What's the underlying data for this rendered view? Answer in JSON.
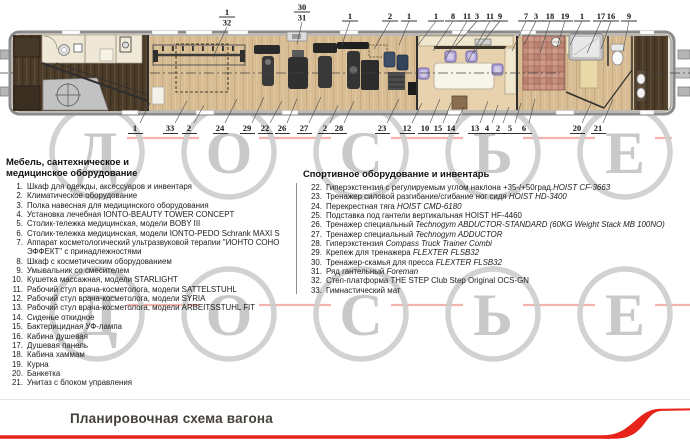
{
  "watermark": {
    "letters": [
      "Д",
      "О",
      "С",
      "Ь",
      "Е"
    ],
    "circle_color": "#cdcdcd",
    "letter_color": "#c7c7c7",
    "line_color": "#f2a6a0"
  },
  "plan": {
    "top_callouts": [
      {
        "t": "1",
        "b": "32",
        "x": 227,
        "yb": 17,
        "dx": -14,
        "dy": 30
      },
      {
        "t": "30",
        "b": "31",
        "x": 302,
        "yb": 12,
        "dx": -5,
        "dy": 22
      },
      {
        "t": "1",
        "x": 350,
        "dx": -8,
        "dy": 24
      },
      {
        "t": "2",
        "x": 390,
        "dx": -16,
        "dy": 28
      },
      {
        "t": "1",
        "x": 409,
        "dx": -10,
        "dy": 24
      },
      {
        "t": "1",
        "x": 436,
        "dx": -18,
        "dy": 24
      },
      {
        "t": "8",
        "x": 453,
        "dx": -20,
        "dy": 30
      },
      {
        "t": "11",
        "x": 467,
        "dx": -22,
        "dy": 38
      },
      {
        "t": "3",
        "x": 477,
        "dx": -24,
        "dy": 28
      },
      {
        "t": "11",
        "x": 490,
        "dx": -22,
        "dy": 40
      },
      {
        "t": "9",
        "x": 500,
        "dx": -26,
        "dy": 32
      },
      {
        "t": "7",
        "x": 526,
        "dx": -14,
        "dy": 30
      },
      {
        "t": "3",
        "x": 536,
        "dx": -12,
        "dy": 24
      },
      {
        "t": "18",
        "x": 550,
        "dx": -10,
        "dy": 32
      },
      {
        "t": "19",
        "x": 565,
        "dx": -8,
        "dy": 26
      },
      {
        "t": "1",
        "x": 582,
        "dx": -12,
        "dy": 24
      },
      {
        "t": "17",
        "x": 601,
        "dx": -14,
        "dy": 32
      },
      {
        "t": "16",
        "x": 611,
        "dx": -10,
        "dy": 28
      },
      {
        "t": "9",
        "x": 629,
        "dx": -6,
        "dy": 30
      }
    ],
    "bottom_callouts": [
      {
        "t": "1",
        "x": 135,
        "dx": 10,
        "dy": 20
      },
      {
        "t": "33",
        "x": 170,
        "dx": 12,
        "dy": 22
      },
      {
        "t": "2",
        "x": 189,
        "dx": 10,
        "dy": 18
      },
      {
        "t": "24",
        "x": 220,
        "dx": 12,
        "dy": 24
      },
      {
        "t": "29",
        "x": 247,
        "dx": 12,
        "dy": 26
      },
      {
        "t": "22",
        "x": 265,
        "dx": 12,
        "dy": 22
      },
      {
        "t": "26",
        "x": 282,
        "dx": 10,
        "dy": 24
      },
      {
        "t": "27",
        "x": 304,
        "dx": 12,
        "dy": 26
      },
      {
        "t": "2",
        "x": 325,
        "dx": 8,
        "dy": 18
      },
      {
        "t": "28",
        "x": 339,
        "dx": 10,
        "dy": 22
      },
      {
        "t": "23",
        "x": 382,
        "dx": 12,
        "dy": 24
      },
      {
        "t": "12",
        "x": 407,
        "dx": 10,
        "dy": 20
      },
      {
        "t": "10",
        "x": 425,
        "dx": 10,
        "dy": 24
      },
      {
        "t": "15",
        "x": 438,
        "dx": 8,
        "dy": 20
      },
      {
        "t": "14",
        "x": 451,
        "dx": 8,
        "dy": 16
      },
      {
        "t": "13",
        "x": 475,
        "dx": 8,
        "dy": 22
      },
      {
        "t": "4",
        "x": 487,
        "dx": 6,
        "dy": 18
      },
      {
        "t": "2",
        "x": 498,
        "dx": 6,
        "dy": 16
      },
      {
        "t": "5",
        "x": 510,
        "dx": 6,
        "dy": 20
      },
      {
        "t": "6",
        "x": 524,
        "dx": 6,
        "dy": 24
      },
      {
        "t": "20",
        "x": 577,
        "dx": 10,
        "dy": 22
      },
      {
        "t": "21",
        "x": 598,
        "dx": 10,
        "dy": 24
      }
    ]
  },
  "left_list": {
    "title": [
      "Мебель, сантехническое и",
      "медицинское оборудование"
    ],
    "items": [
      {
        "num": "1.",
        "text": "Шкаф для одежды, аксессуаров и инвентаря"
      },
      {
        "num": "2.",
        "text": "Климатическое оборудование"
      },
      {
        "num": "3.",
        "text": "Полка навесная для медицинского оборудования"
      },
      {
        "num": "4.",
        "text": "Установка лечебная IONTO-BEAUTY TOWER CONCEPT"
      },
      {
        "num": "5.",
        "text": "Столик-тележка медицинская, модели BOBY III"
      },
      {
        "num": "6.",
        "text": "Столик-тележка медицинская, модели IONTO-PEDO Schrank MAXI S"
      },
      {
        "num": "7.",
        "text": "Аппарат косметологический ультразвуковой терапии \"ИОНТО СОНО ЭФФЕКТ\" с принадлежностями"
      },
      {
        "num": "8.",
        "text": "Шкаф с косметическим оборудованием"
      },
      {
        "num": "9.",
        "text": "Умывальник со смесителем"
      },
      {
        "num": "10.",
        "text": "Кушетка массажная, модели STARLIGHT"
      },
      {
        "num": "11.",
        "text": "Рабочий стул врача-косметолога, модели SATTELSTUHL"
      },
      {
        "num": "12.",
        "text": "Рабочий стул врача-косметолога, модели SYRIA"
      },
      {
        "num": "13.",
        "text": "Рабочий стул врача-косметолога, модели ARBEITSSTUHL FIT"
      },
      {
        "num": "14.",
        "text": "Сиденье откидное"
      },
      {
        "num": "15.",
        "text": "Бактерицидная УФ-лампа"
      },
      {
        "num": "16.",
        "text": "Кабина душевая"
      },
      {
        "num": "17.",
        "text": "Душевая панель"
      },
      {
        "num": "18.",
        "text": "Кабина хаммам"
      },
      {
        "num": "19.",
        "text": "Курна"
      },
      {
        "num": "20.",
        "text": "Банкетка"
      },
      {
        "num": "21.",
        "text": "Унитаз с блоком управления"
      }
    ]
  },
  "right_list": {
    "title": "Спортивное оборудование и инвентарь",
    "items": [
      {
        "num": "22.",
        "text": "Гиперэкстензия с регулируемым углом наклона +35-/+50град.",
        "em": "HOIST CF-3663"
      },
      {
        "num": "23.",
        "text": "Тренажер силовой разгибание/сгибание ног сидя",
        "em": " HOIST HD-3400"
      },
      {
        "num": "24.",
        "text": "Перекрестная тяга",
        "em": " HOIST CMD-6180"
      },
      {
        "num": "25.",
        "text": "Подставка под гантели вертикальная HOIST HF-4460",
        "em": ""
      },
      {
        "num": "26.",
        "text": "Тренажер специальный",
        "em": " Technogym ABDUCTOR-STANDARD (60KG Weight Stack MB 100NO)"
      },
      {
        "num": "27.",
        "text": "Тренажер специальный",
        "em": " Technogym ADDUCTOR"
      },
      {
        "num": "28.",
        "text": "Гиперэкстензия",
        "em": " Compass Truck Trainer Combi"
      },
      {
        "num": "29.",
        "text": "Крепеж для тренажера",
        "em": " FLEXTER FLSB32"
      },
      {
        "num": "30.",
        "text": "Тренажер-скамья для пресса",
        "em": " FLEXTER FLSB32"
      },
      {
        "num": "31.",
        "text": "Ряд гантельный",
        "em": " Foreman"
      },
      {
        "num": "32.",
        "text": "Степ-платформа THE STEP Club Step Original OCS-GN",
        "em": ""
      },
      {
        "num": "33.",
        "text": "Гимнастический мат",
        "em": ""
      }
    ]
  },
  "footer": {
    "title": "Планировочная схема вагона",
    "accent_color": "#e8231a"
  }
}
